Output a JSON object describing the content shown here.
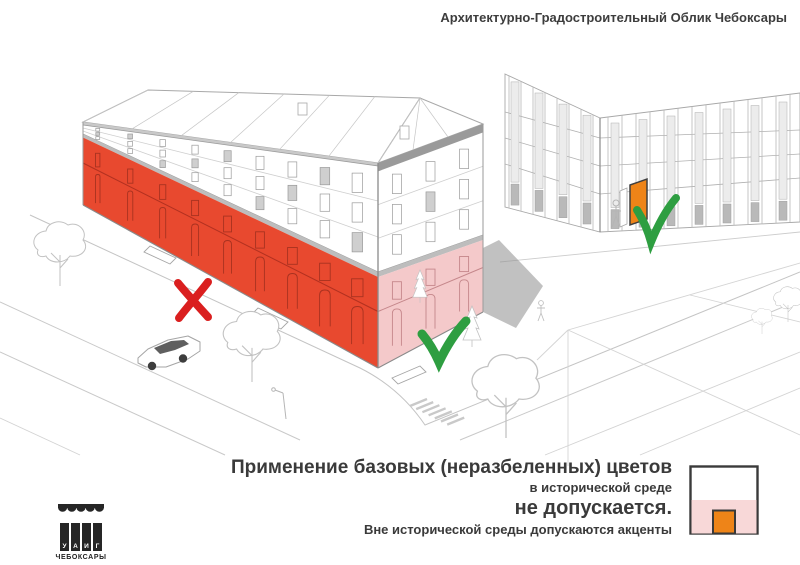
{
  "header": {
    "title": "Архитектурно-Градостроительный Облик Чебоксары"
  },
  "caption": {
    "line1": "Применение базовых (неразбеленных) цветов",
    "line2": "в исторической среде",
    "line3": "не допускается.",
    "line4": "Вне исторической среды допускаются акценты"
  },
  "legend": {
    "border": "#3A3A3A",
    "upper": "#FFFFFF",
    "lower": "#F8D8D8",
    "door": "#EE8418"
  },
  "logo": {
    "letters": [
      "У",
      "А",
      "И",
      "Г"
    ],
    "city": "ЧЕБОКСАРЫ"
  },
  "illustration": {
    "colors": {
      "red_facade": "#E8492F",
      "pink_facade": "#F4C9CA",
      "orange_door": "#EE8418",
      "x_mark": "#DA1F1F",
      "check_mark": "#2E9E41"
    }
  }
}
